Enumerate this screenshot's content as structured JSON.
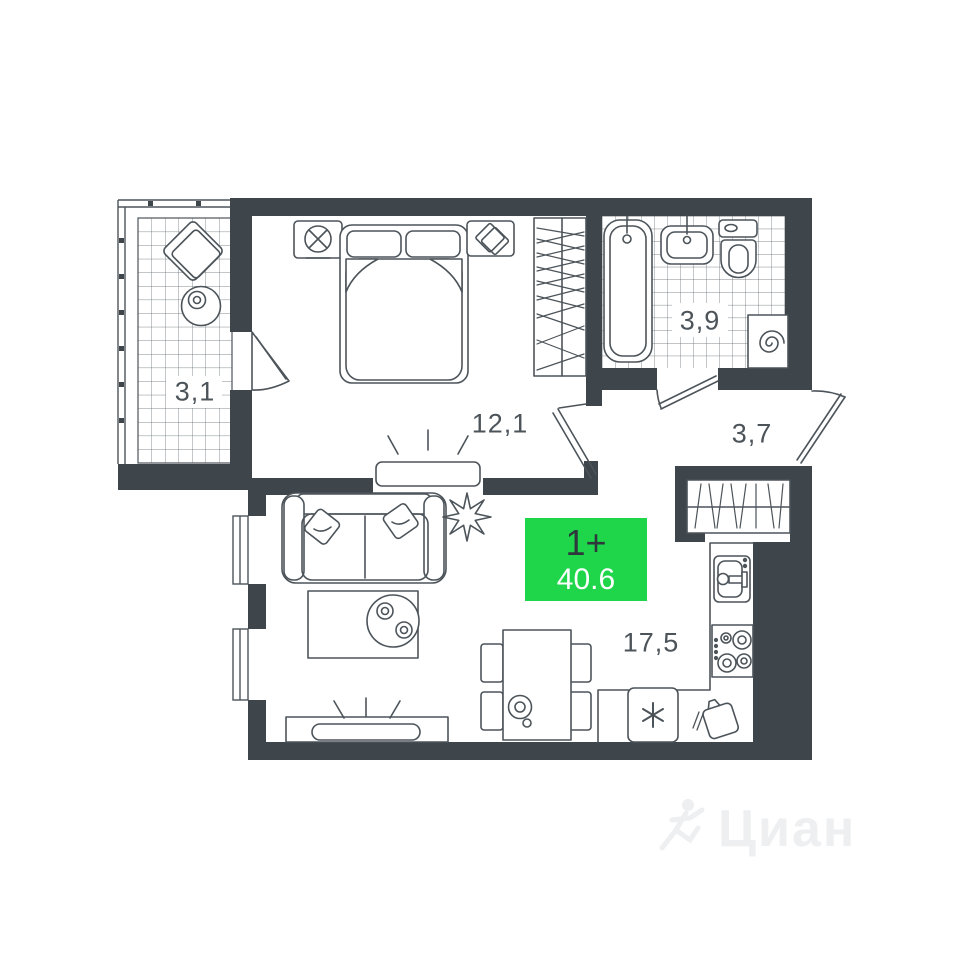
{
  "plan_type": "apartment-floor-plan",
  "badge": {
    "rooms": "1+",
    "area": "40.6"
  },
  "rooms": {
    "balcony": "3,1",
    "bedroom": "12,1",
    "bathroom": "3,9",
    "hallway": "3,7",
    "living_kitchen": "17,5"
  },
  "watermark": {
    "brand": "Циан"
  },
  "colors": {
    "wall": "#3e464c",
    "line": "#4c545a",
    "tile_line": "#5a6268",
    "badge_green": "#1fd64b",
    "badge_rooms_text": "#2e373c",
    "badge_area_text": "#ffffff",
    "watermark_text": "#edeff0",
    "background": "#ffffff"
  }
}
